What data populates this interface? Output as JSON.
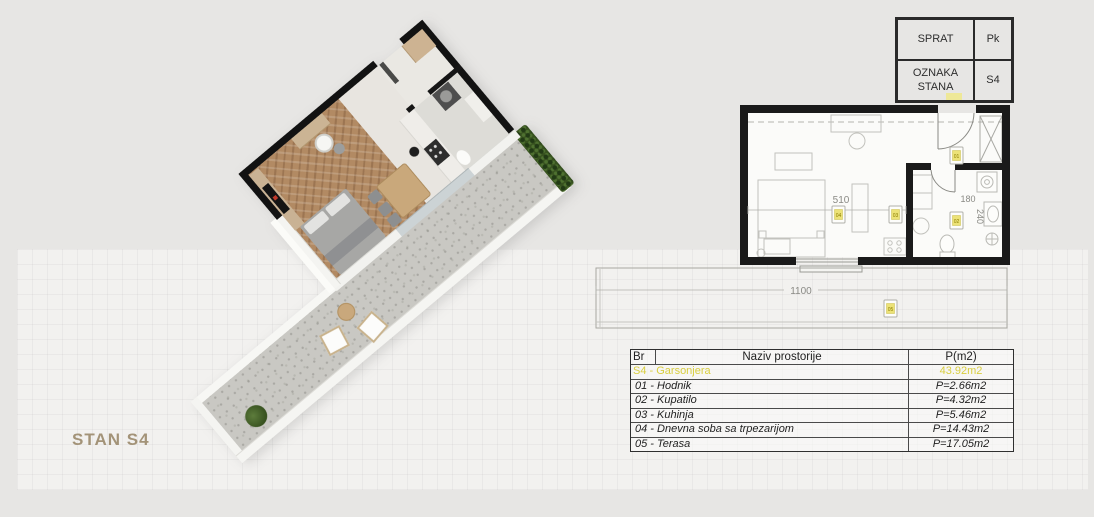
{
  "title": {
    "label": "STAN S4"
  },
  "meta_table": {
    "rows": [
      {
        "label": "SPRAT",
        "value": "Pk"
      },
      {
        "label": "OZNAKA STANA",
        "value": "S4"
      }
    ]
  },
  "plan2d": {
    "dims": {
      "living_width": "510",
      "bath_width": "180",
      "bath_depth": "240",
      "terrace_width": "1100"
    },
    "markers": {
      "hall": "01",
      "bath": "02",
      "kitchen": "03",
      "living": "04",
      "terrace": "05"
    }
  },
  "area_table": {
    "headers": {
      "nr": "Br",
      "name": "Naziv prostorije",
      "area": "P(m2)"
    },
    "summary": {
      "name": "S4 - Garsonjera",
      "area": "43.92m2"
    },
    "rows": [
      {
        "name": "01 - Hodnik",
        "area": "P=2.66m2"
      },
      {
        "name": "02 - Kupatilo",
        "area": "P=4.32m2"
      },
      {
        "name": "03 - Kuhinja",
        "area": "P=5.46m2"
      },
      {
        "name": "04 - Dnevna soba sa trpezarijom",
        "area": "P=14.43m2"
      },
      {
        "name": "05 - Terasa",
        "area": "P=17.05m2"
      }
    ]
  },
  "colors": {
    "accent_yellow": "#d9ce3f",
    "marker_yellow": "#ece277",
    "title_tan": "#a39378",
    "wall_black": "#1a1a1a"
  }
}
